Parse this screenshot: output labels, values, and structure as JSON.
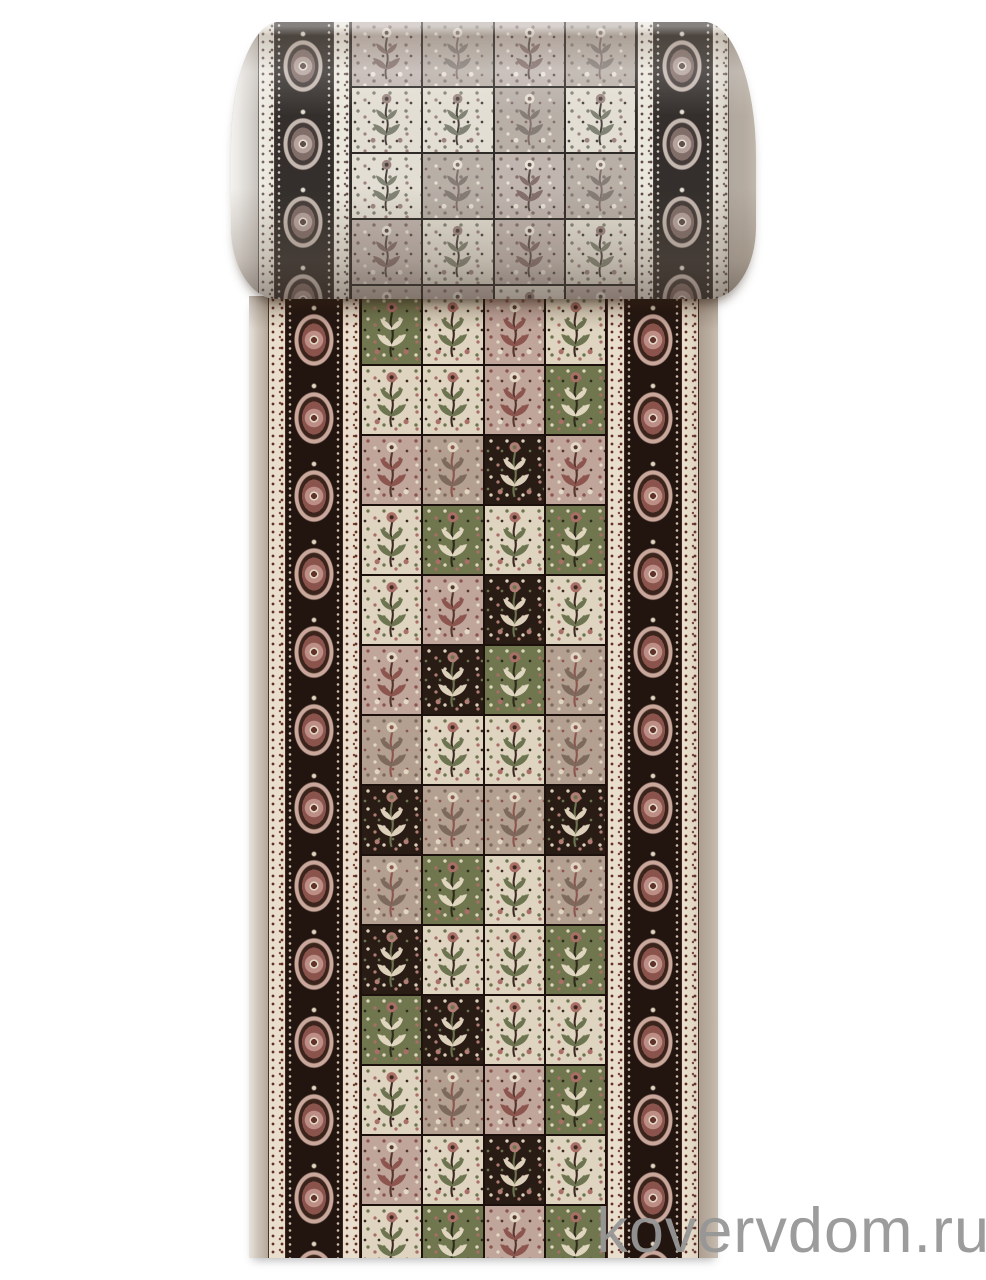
{
  "scene": {
    "description": "Product photograph of a beige oriental panel-design runner carpet, rolled up at the top and unrolled vertically, on a white background",
    "background_color": "#ffffff"
  },
  "watermark": {
    "text": "kovervdom.ru",
    "color": "#979797"
  },
  "rug": {
    "palette": {
      "selvage": "#c6bbad",
      "guard_background": "#e8decb",
      "guard_mark": "#5e2e27",
      "border_background": "#221510",
      "medallion_rose": "#bd8e86",
      "medallion_cream": "#e2d5c1",
      "medallion_core": "#5f332c",
      "grid_line": "#1c110c"
    },
    "panel_styles": {
      "cream": {
        "bg": "#ded4bf",
        "a": "#6d7450",
        "b": "#a96e66",
        "c": "#3c2a22"
      },
      "rose": {
        "bg": "#c0a59b",
        "a": "#8c564f",
        "b": "#e4d9c6",
        "c": "#55352c"
      },
      "beige": {
        "bg": "#b3a090",
        "a": "#7d6a5c",
        "b": "#e0d5c0",
        "c": "#8c564f"
      },
      "dark": {
        "bg": "#281c15",
        "a": "#ddd0ba",
        "b": "#b07c74",
        "c": "#6d7450"
      },
      "green": {
        "bg": "#70774f",
        "a": "#e0d6bf",
        "b": "#a96e66",
        "c": "#2f2b1c"
      }
    },
    "runner_rows": [
      [
        "green",
        "cream",
        "rose",
        "cream"
      ],
      [
        "cream",
        "cream",
        "rose",
        "green"
      ],
      [
        "rose",
        "beige",
        "dark",
        "rose"
      ],
      [
        "cream",
        "green",
        "cream",
        "green"
      ],
      [
        "cream",
        "rose",
        "dark",
        "cream"
      ],
      [
        "rose",
        "dark",
        "green",
        "beige"
      ],
      [
        "beige",
        "cream",
        "cream",
        "beige"
      ],
      [
        "dark",
        "beige",
        "beige",
        "dark"
      ],
      [
        "beige",
        "green",
        "cream",
        "beige"
      ],
      [
        "dark",
        "cream",
        "cream",
        "green"
      ],
      [
        "green",
        "dark",
        "cream",
        "cream"
      ],
      [
        "cream",
        "beige",
        "rose",
        "green"
      ],
      [
        "rose",
        "cream",
        "dark",
        "cream"
      ],
      [
        "cream",
        "green",
        "rose",
        "green"
      ]
    ],
    "roll_rows": [
      [
        "rose",
        "beige",
        "rose",
        "beige"
      ],
      [
        "cream",
        "cream",
        "beige",
        "cream"
      ],
      [
        "cream",
        "beige",
        "rose",
        "beige"
      ],
      [
        "rose",
        "cream",
        "rose",
        "cream"
      ],
      [
        "beige",
        "rose",
        "cream",
        "rose"
      ]
    ]
  }
}
